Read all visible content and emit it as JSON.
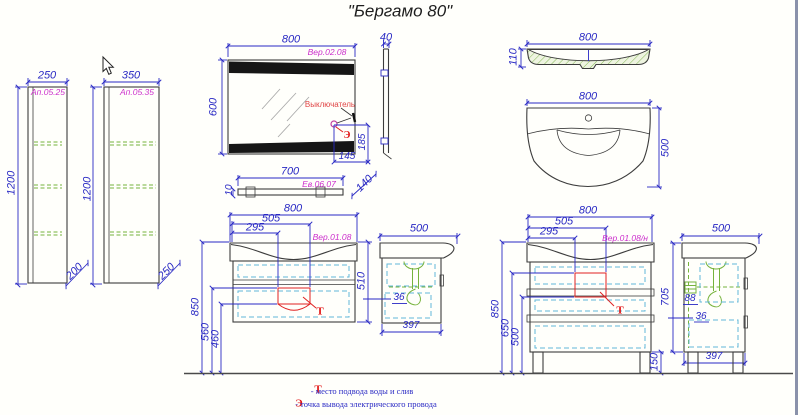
{
  "title": "\"Бергамо 80\"",
  "cabinet_250": {
    "width": "250",
    "code": "Ап.05.25",
    "height": "1200",
    "depth": "200"
  },
  "cabinet_350": {
    "width": "350",
    "code": "Ап.05.35",
    "height": "1200",
    "depth": "250"
  },
  "mirror": {
    "width": "800",
    "code": "Вер.02.08",
    "height": "600",
    "side_depth": "40",
    "switch_label": "Выключатель",
    "switch_symbol": "Э",
    "dim_to_bottom": "185",
    "dim_to_edge": "145"
  },
  "shelf": {
    "width": "700",
    "code": "Ев.06.07",
    "thickness": "10",
    "depth": "140"
  },
  "washbasin": {
    "front_width": "800",
    "front_height": "110",
    "plan_width": "800",
    "plan_depth": "500"
  },
  "vanity_wall": {
    "width": "800",
    "dim_505": "505",
    "dim_295": "295",
    "code": "Вер.01.08",
    "height": "510",
    "dim_850": "850",
    "dim_560": "560",
    "dim_460": "460",
    "t_symbol": "Т"
  },
  "vanity_wall_side": {
    "depth": "500",
    "dim_36": "36",
    "dim_397": "397"
  },
  "vanity_floor": {
    "width": "800",
    "dim_505": "505",
    "dim_295": "295",
    "code": "Вер.01.08/н",
    "dim_850": "850",
    "dim_650": "650",
    "dim_500": "500",
    "leg_height": "150",
    "t_symbol": "Т"
  },
  "vanity_floor_side": {
    "depth": "500",
    "height": "705",
    "dim_88": "88",
    "dim_36": "36",
    "dim_397": "397"
  },
  "legend": {
    "t_symbol": "Т",
    "t_text": "- место подвода воды и слив",
    "e_symbol": "Э",
    "e_text": "- точка вывода электрического провода"
  }
}
